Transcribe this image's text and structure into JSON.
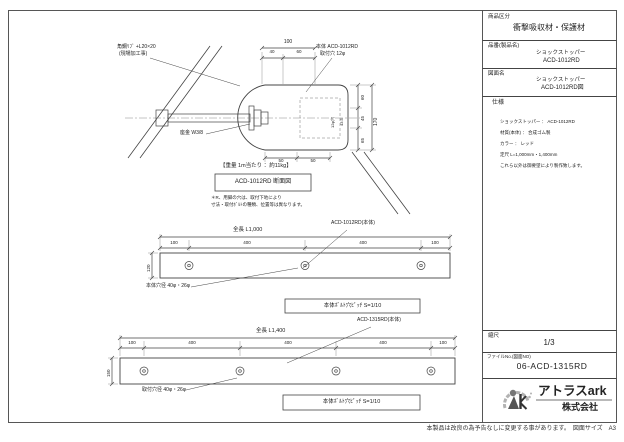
{
  "sheet": {
    "footer_note": "本製品は改良の為予告なしに変更する事があります。　図面サイズ　A3"
  },
  "title_block": {
    "category_label": "商品区分",
    "category_value": "衝撃吸収材・保護材",
    "part_no_label": "品番(製品名)",
    "part_no_line1": "ショックストッパー",
    "part_no_line2": "ACD-1012RD",
    "drawing_name_label": "図面名",
    "drawing_name_line1": "ショックストッパー",
    "drawing_name_line2": "ACD-1012RD図",
    "spec_label": "仕様",
    "spec_lines": [
      "ショックストッパー ： ACD-1012RD",
      "材質(本体) ： 合成ゴム製",
      "カラー ： レッド",
      "定尺 L=1,000mm・1,400mm",
      "これら以外は御要望により製作致します。"
    ],
    "scale_label": "縮尺",
    "scale_value": "1/3",
    "file_no_label": "ファイルNo.(図面NO)",
    "file_no_value": "06-ACD-1315RD",
    "company_name": "アトラスark",
    "company_type": "株式会社"
  },
  "section_view": {
    "label_rib_line1": "角鋼ﾘﾌﾞ +L20×20",
    "label_rib_line2": "(現場加工事)",
    "label_washer": "座金 W3/8",
    "label_body_line1": "本体 ACD-1012RD",
    "label_body_line2": "取付穴 12φ",
    "dims": {
      "top_total": "100",
      "top_a": "40",
      "top_b": "60",
      "right_total": "170",
      "right_a": "60",
      "right_b": "45",
      "right_c": "65",
      "inner_hole": "12φ穴",
      "inner_depth": "43.5",
      "bottom_a": "50",
      "bottom_b": "50"
    },
    "weight_note": "【重量 1m当たり ：約11kg】",
    "caption": "ACD-1012RD 断面図",
    "note_line1": "＊R、用脚の穴は、取付下地により",
    "note_line2": "寸法・取付ﾎﾞﾙﾄの種類、位置等は異なります。"
  },
  "plan_view_1": {
    "part_label": "ACD-1012RD(本体)",
    "length_label": "全長 L1,000",
    "segments": [
      "100",
      "400",
      "400",
      "100"
    ],
    "height": "120",
    "hole_note": "本体穴径 40φ・26φ",
    "pitch_note": "本体ﾎﾞﾙﾄ穴ﾋﾟｯﾁ S=1/10"
  },
  "plan_view_2": {
    "part_label": "ACD-1315RD(本体)",
    "length_label": "全長 L1,400",
    "segments": [
      "100",
      "400",
      "400",
      "400",
      "100"
    ],
    "height": "150",
    "hole_note": "取付穴径 40φ・26φ",
    "pitch_note": "本体ﾎﾞﾙﾄ穴ﾋﾟｯﾁ S=1/10"
  }
}
